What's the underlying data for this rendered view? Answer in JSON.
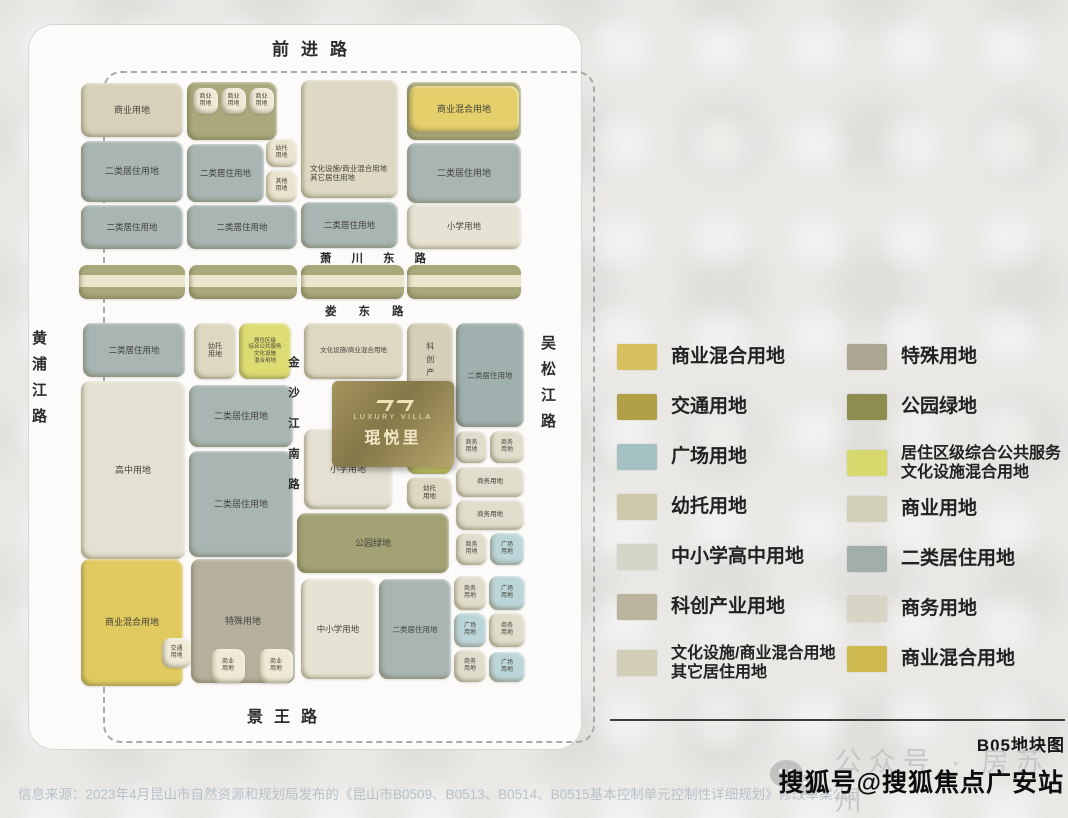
{
  "map": {
    "roads": {
      "top": "前进路",
      "bottom": "景王路",
      "left": "黄浦江路",
      "right": "吴松江路",
      "mid1": "萧川东路",
      "mid2": "娄东路",
      "vertical": "金沙江南路"
    },
    "logo": {
      "brand_en": "LUXURY VILLA",
      "brand_cn": "琨悦里"
    },
    "strips": [
      {
        "x": 78,
        "y": 264,
        "w": 106,
        "h": 34
      },
      {
        "x": 188,
        "y": 264,
        "w": 108,
        "h": 34
      },
      {
        "x": 300,
        "y": 264,
        "w": 103,
        "h": 34
      },
      {
        "x": 406,
        "y": 264,
        "w": 114,
        "h": 34
      }
    ],
    "blocks": [
      {
        "x": 80,
        "y": 82,
        "w": 102,
        "h": 54,
        "c": "#d8d1ba",
        "l": "商业用地",
        "fs": 9
      },
      {
        "x": 186,
        "y": 81,
        "w": 90,
        "h": 58,
        "c": "#a9a97c",
        "l": "",
        "fs": 9
      },
      {
        "x": 192,
        "y": 87,
        "w": 25,
        "h": 26,
        "c": "#efe9d6",
        "l": "商业\n用地",
        "fs": 6
      },
      {
        "x": 220,
        "y": 87,
        "w": 25,
        "h": 26,
        "c": "#efe9d6",
        "l": "商业\n用地",
        "fs": 6
      },
      {
        "x": 248,
        "y": 87,
        "w": 25,
        "h": 26,
        "c": "#efe9d6",
        "l": "商业\n用地",
        "fs": 6
      },
      {
        "x": 406,
        "y": 81,
        "w": 114,
        "h": 58,
        "c": "#a9a97c",
        "l": "",
        "fs": 9
      },
      {
        "x": 408,
        "y": 85,
        "w": 110,
        "h": 46,
        "c": "#e5cf6b",
        "l": "商业混合用地",
        "fs": 9
      },
      {
        "x": 300,
        "y": 79,
        "w": 97,
        "h": 118,
        "c": "#ded9c4",
        "l": "文化设施/商业混合用地\n其它居住用地",
        "fs": 7.5,
        "low": true
      },
      {
        "x": 80,
        "y": 140,
        "w": 102,
        "h": 61,
        "c": "#a8b5b3",
        "l": "二类居住用地",
        "fs": 9
      },
      {
        "x": 186,
        "y": 143,
        "w": 77,
        "h": 58,
        "c": "#a8b5b3",
        "l": "二类居住用地",
        "fs": 8.5
      },
      {
        "x": 265,
        "y": 138,
        "w": 31,
        "h": 28,
        "c": "#eae4d0",
        "l": "幼托\n用地",
        "fs": 6
      },
      {
        "x": 265,
        "y": 169,
        "w": 31,
        "h": 32,
        "c": "#eae4d0",
        "l": "其他\n用地",
        "fs": 6
      },
      {
        "x": 406,
        "y": 142,
        "w": 114,
        "h": 60,
        "c": "#a8b5b3",
        "l": "二类居住用地",
        "fs": 9
      },
      {
        "x": 80,
        "y": 204,
        "w": 102,
        "h": 44,
        "c": "#a8b5b3",
        "l": "二类居住用地",
        "fs": 8.5
      },
      {
        "x": 186,
        "y": 204,
        "w": 110,
        "h": 44,
        "c": "#a8b5b3",
        "l": "二类居住用地",
        "fs": 8.5
      },
      {
        "x": 300,
        "y": 201,
        "w": 97,
        "h": 46,
        "c": "#a8b5b3",
        "l": "二类居住用地",
        "fs": 8.5
      },
      {
        "x": 406,
        "y": 203,
        "w": 114,
        "h": 45,
        "c": "#e7e3d4",
        "l": "小学用地",
        "fs": 8.5
      },
      {
        "x": 82,
        "y": 322,
        "w": 102,
        "h": 54,
        "c": "#a8b5b3",
        "l": "二类居住用地",
        "fs": 8.5
      },
      {
        "x": 193,
        "y": 322,
        "w": 42,
        "h": 56,
        "c": "#ded8c3",
        "l": "幼托\n用地",
        "fs": 7
      },
      {
        "x": 238,
        "y": 322,
        "w": 52,
        "h": 56,
        "c": "#dddc73",
        "l": "居住区级\n综合公共服务\n文化设施\n混合用地",
        "fs": 5.5
      },
      {
        "x": 303,
        "y": 322,
        "w": 99,
        "h": 56,
        "c": "#ded8c3",
        "l": "文化设施/商业混合用地",
        "fs": 6.5
      },
      {
        "x": 406,
        "y": 322,
        "w": 46,
        "h": 116,
        "c": "#d5cfba",
        "l": "科创产业用地",
        "fs": 8,
        "vertical": true
      },
      {
        "x": 455,
        "y": 322,
        "w": 68,
        "h": 104,
        "c": "#9fb0ae",
        "l": "二类居住用地",
        "fs": 7.5
      },
      {
        "x": 80,
        "y": 380,
        "w": 104,
        "h": 178,
        "c": "#e5e1d2",
        "l": "高中用地",
        "fs": 9
      },
      {
        "x": 188,
        "y": 384,
        "w": 104,
        "h": 62,
        "c": "#a8b5b3",
        "l": "二类居住用地",
        "fs": 9
      },
      {
        "x": 188,
        "y": 450,
        "w": 104,
        "h": 106,
        "c": "#a8b5b3",
        "l": "二类居住用地",
        "fs": 9
      },
      {
        "x": 303,
        "y": 428,
        "w": 88,
        "h": 80,
        "c": "#e5e1d2",
        "l": "小学用地",
        "fs": 9
      },
      {
        "x": 406,
        "y": 437,
        "w": 45,
        "h": 36,
        "c": "#dddc73",
        "l": "居住区级综合\n公共服务文化\n设施混合用地",
        "fs": 5
      },
      {
        "x": 406,
        "y": 476,
        "w": 45,
        "h": 32,
        "c": "#ded8c3",
        "l": "幼托\n用地",
        "fs": 6.5
      },
      {
        "x": 455,
        "y": 430,
        "w": 31,
        "h": 32,
        "c": "#e1ddcc",
        "l": "商务\n用地",
        "fs": 6
      },
      {
        "x": 489,
        "y": 430,
        "w": 34,
        "h": 32,
        "c": "#e1ddcc",
        "l": "商务\n用地",
        "fs": 6
      },
      {
        "x": 455,
        "y": 466,
        "w": 68,
        "h": 30,
        "c": "#e1ddcc",
        "l": "商务用地",
        "fs": 6.5
      },
      {
        "x": 455,
        "y": 499,
        "w": 68,
        "h": 30,
        "c": "#e1ddcc",
        "l": "商务用地",
        "fs": 6.5
      },
      {
        "x": 455,
        "y": 532,
        "w": 31,
        "h": 32,
        "c": "#e1ddcc",
        "l": "商务\n用地",
        "fs": 6
      },
      {
        "x": 489,
        "y": 532,
        "w": 34,
        "h": 32,
        "c": "#bcd5d9",
        "l": "广场\n用地",
        "fs": 6
      },
      {
        "x": 296,
        "y": 512,
        "w": 152,
        "h": 60,
        "c": "#a2a275",
        "l": "公园绿地",
        "fs": 9
      },
      {
        "x": 80,
        "y": 558,
        "w": 102,
        "h": 127,
        "c": "#e0ca60",
        "l": "商业混合用地",
        "fs": 9
      },
      {
        "x": 161,
        "y": 637,
        "w": 29,
        "h": 30,
        "c": "#efe9d6",
        "l": "交通\n用地",
        "fs": 6
      },
      {
        "x": 190,
        "y": 558,
        "w": 104,
        "h": 124,
        "c": "#b4b09d",
        "l": "特殊用地",
        "fs": 9
      },
      {
        "x": 210,
        "y": 648,
        "w": 34,
        "h": 34,
        "c": "#efe9d6",
        "l": "商业\n用地",
        "fs": 6
      },
      {
        "x": 258,
        "y": 648,
        "w": 34,
        "h": 34,
        "c": "#efe9d6",
        "l": "商业\n用地",
        "fs": 6
      },
      {
        "x": 300,
        "y": 578,
        "w": 74,
        "h": 100,
        "c": "#e7e3d4",
        "l": "中小学用地",
        "fs": 8.5
      },
      {
        "x": 378,
        "y": 578,
        "w": 72,
        "h": 100,
        "c": "#a8b5b3",
        "l": "二类居住用地",
        "fs": 7.5
      },
      {
        "x": 453,
        "y": 575,
        "w": 32,
        "h": 34,
        "c": "#e1ddcc",
        "l": "商务\n用地",
        "fs": 6
      },
      {
        "x": 488,
        "y": 575,
        "w": 36,
        "h": 34,
        "c": "#bcd5d9",
        "l": "广场\n用地",
        "fs": 6
      },
      {
        "x": 453,
        "y": 612,
        "w": 32,
        "h": 34,
        "c": "#bcd5d9",
        "l": "广场\n用地",
        "fs": 6
      },
      {
        "x": 488,
        "y": 612,
        "w": 36,
        "h": 34,
        "c": "#e1ddcc",
        "l": "商务\n用地",
        "fs": 6
      },
      {
        "x": 453,
        "y": 649,
        "w": 32,
        "h": 32,
        "c": "#e1ddcc",
        "l": "商务\n用地",
        "fs": 6
      },
      {
        "x": 488,
        "y": 651,
        "w": 36,
        "h": 30,
        "c": "#bcd5d9",
        "l": "广场\n用地",
        "fs": 6
      }
    ]
  },
  "legend": {
    "left": [
      {
        "label": "商业混合用地",
        "color": "#d9c05e"
      },
      {
        "label": "交通用地",
        "color": "#b2a047"
      },
      {
        "label": "广场用地",
        "color": "#a5c1c4"
      },
      {
        "label": "幼托用地",
        "color": "#cfc9ac"
      },
      {
        "label": "中小学高中用地",
        "color": "#d4d6c8"
      },
      {
        "label": "科创产业用地",
        "color": "#bab49e"
      },
      {
        "label": "文化设施/商业混合用地\n其它居住用地",
        "color": "#d2cdb7",
        "twoline": true
      }
    ],
    "right": [
      {
        "label": "特殊用地",
        "color": "#aaa692"
      },
      {
        "label": "公园绿地",
        "color": "#8d8d50"
      },
      {
        "label": "居住区级综合公共服务\n文化设施混合用地",
        "color": "#d7d96d",
        "twoline": true
      },
      {
        "label": "商业用地",
        "color": "#d3d0b9"
      },
      {
        "label": "二类居住用地",
        "color": "#a2aeaa"
      },
      {
        "label": "商务用地",
        "color": "#d8d4c6"
      },
      {
        "label": "商业混合用地",
        "color": "#cdb94e"
      }
    ]
  },
  "footer": {
    "map_title": "B05地块图",
    "wechat_label": "公众号 · 房苏州",
    "sohu_watermark": "搜狐号@搜狐焦点广安站",
    "source": "信息来源：2023年4月昆山市自然资源和规划局发布的《昆山市B0509、B0513、B0514、B0515基本控制单元控制性详细规划》修改草案公示"
  }
}
